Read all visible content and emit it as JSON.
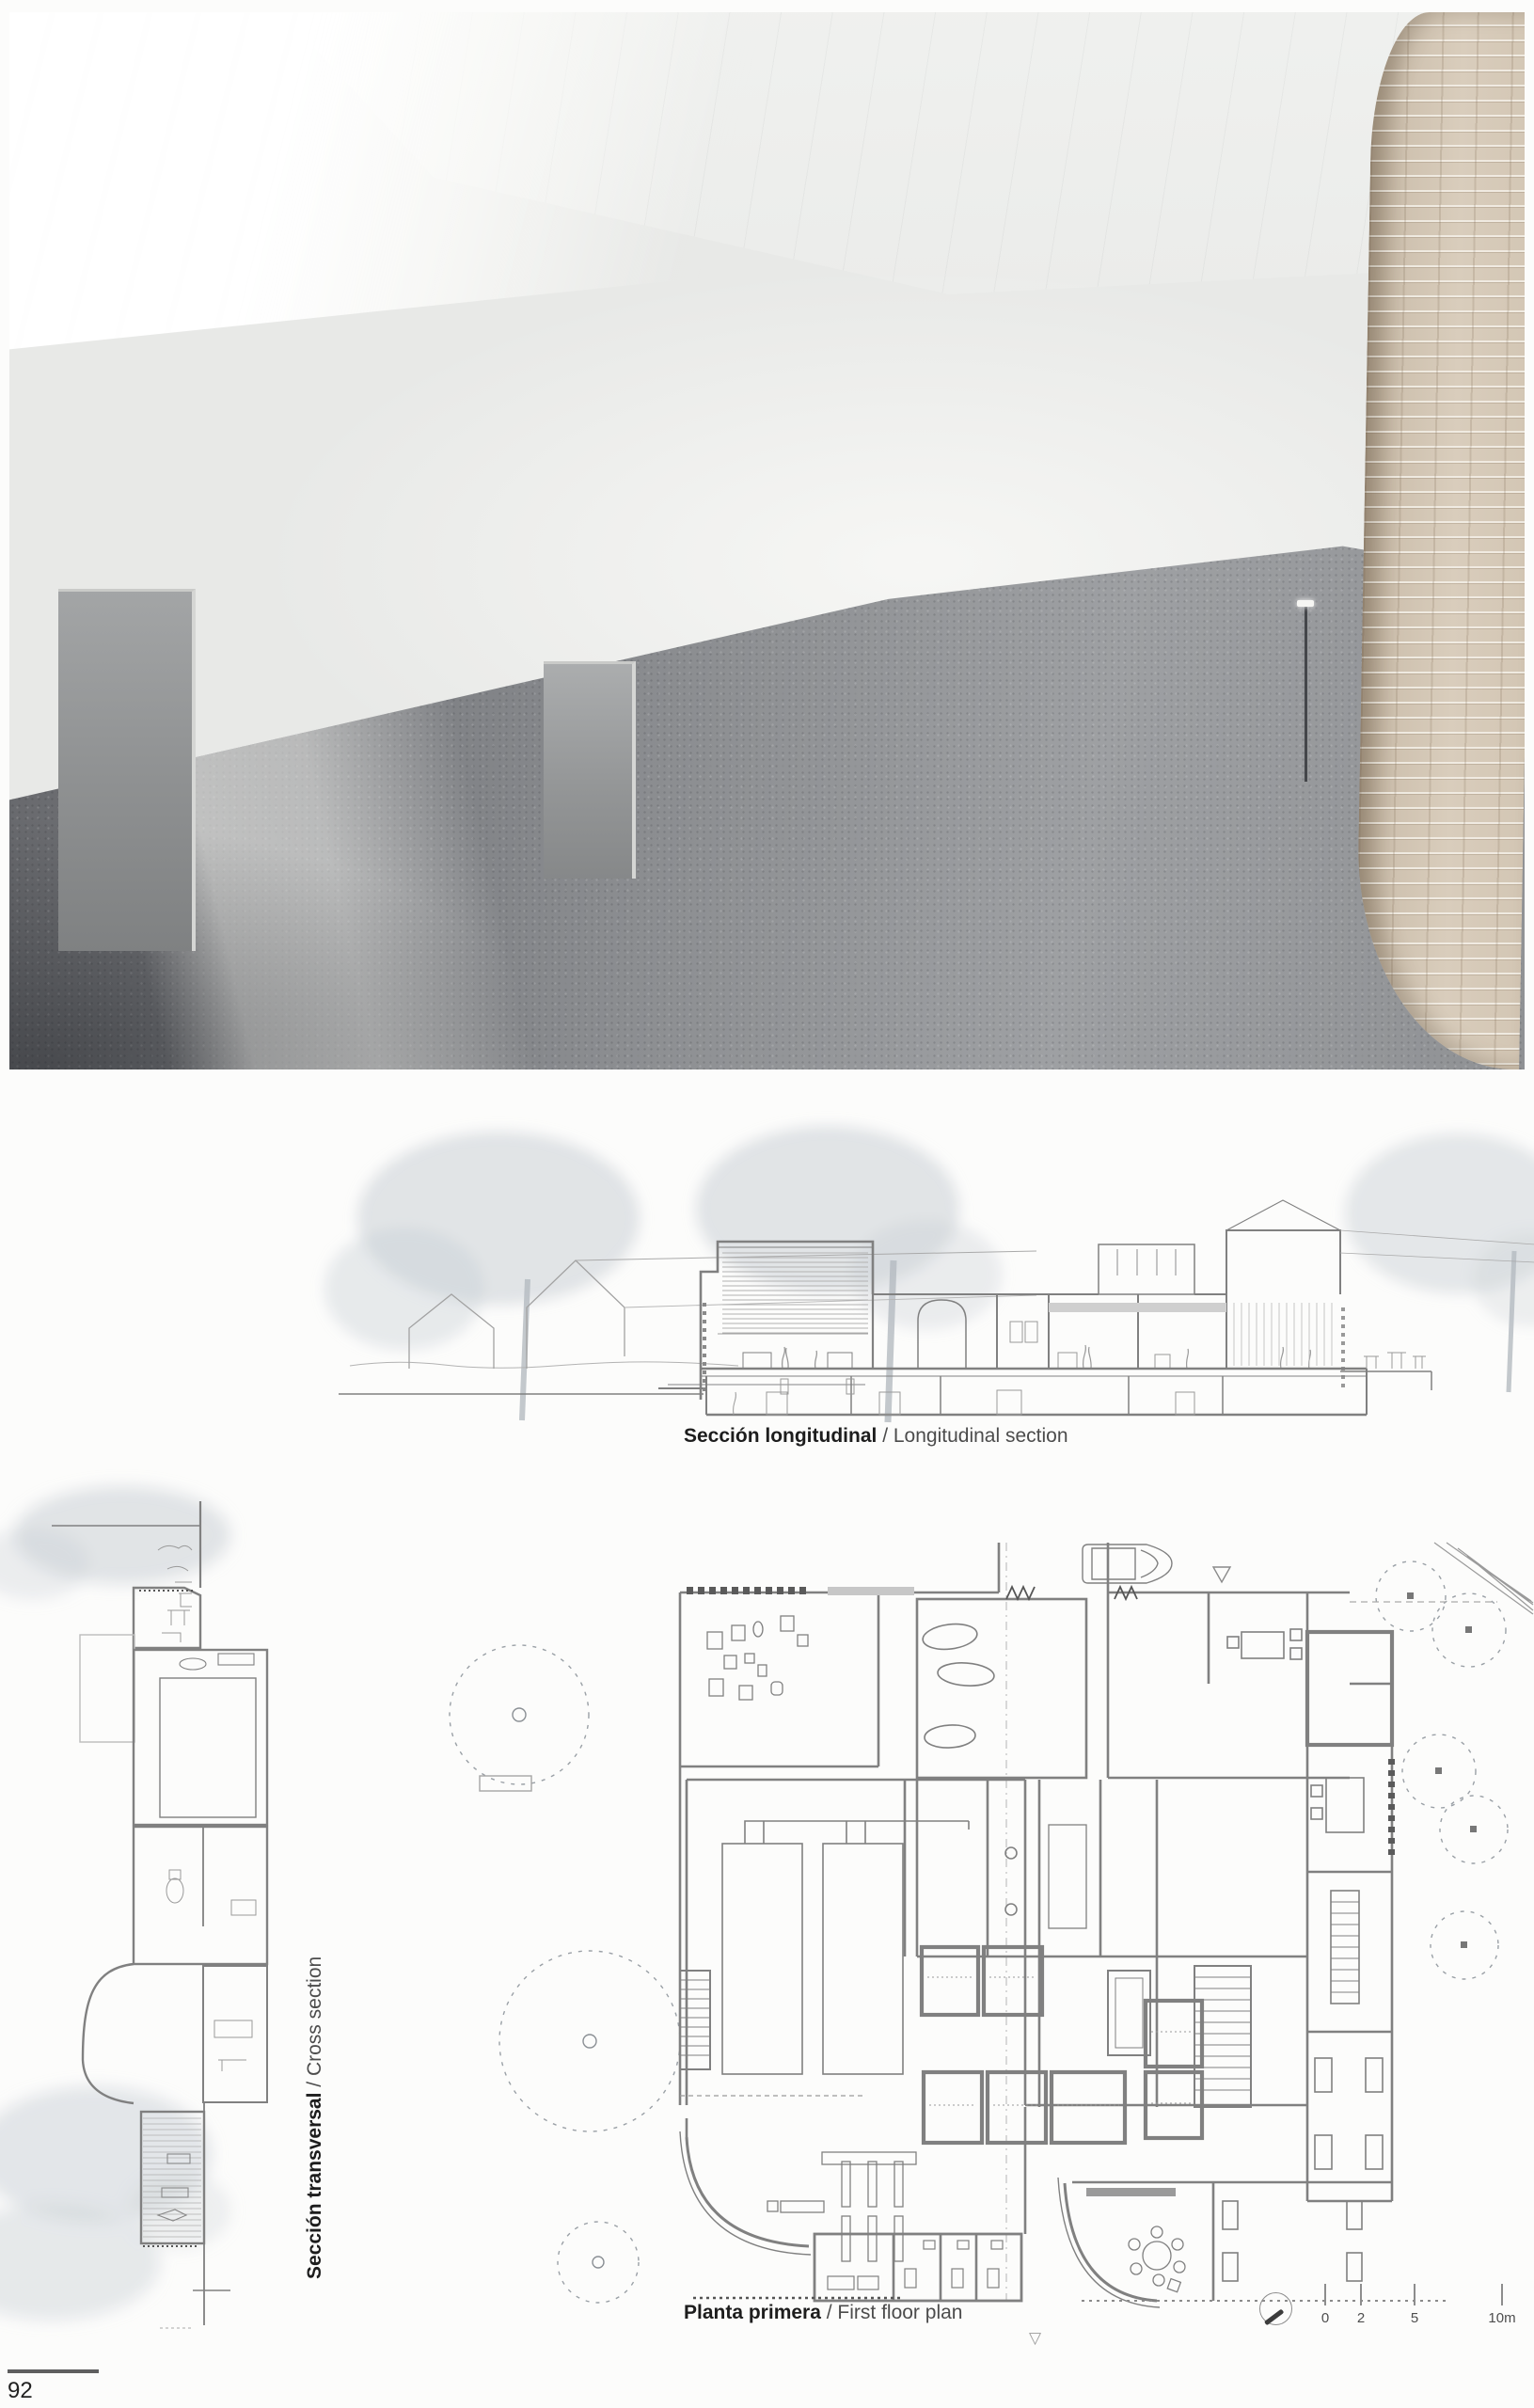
{
  "page": {
    "number": "92"
  },
  "captions": {
    "longitudinal": {
      "bold": "Sección longitudinal",
      "sep": " / ",
      "regular": "Longitudinal section"
    },
    "transversal": {
      "bold": "Sección transversal",
      "sep": " / ",
      "regular": "Cross section"
    },
    "plan": {
      "bold": "Planta primera",
      "sep": " / ",
      "regular": "First floor plan"
    }
  },
  "scale_bar": {
    "ticks": [
      "0",
      "2",
      "5",
      "10m"
    ]
  },
  "markers": {
    "triangle_down": "▽"
  },
  "colors": {
    "brick": "#d2c5b4",
    "floor": "#8a8c8f",
    "drawing_line": "#808080",
    "tree": "#c6ccd2",
    "caption_bold": "#1d1d1d",
    "caption_regular": "#4c4c4c"
  }
}
